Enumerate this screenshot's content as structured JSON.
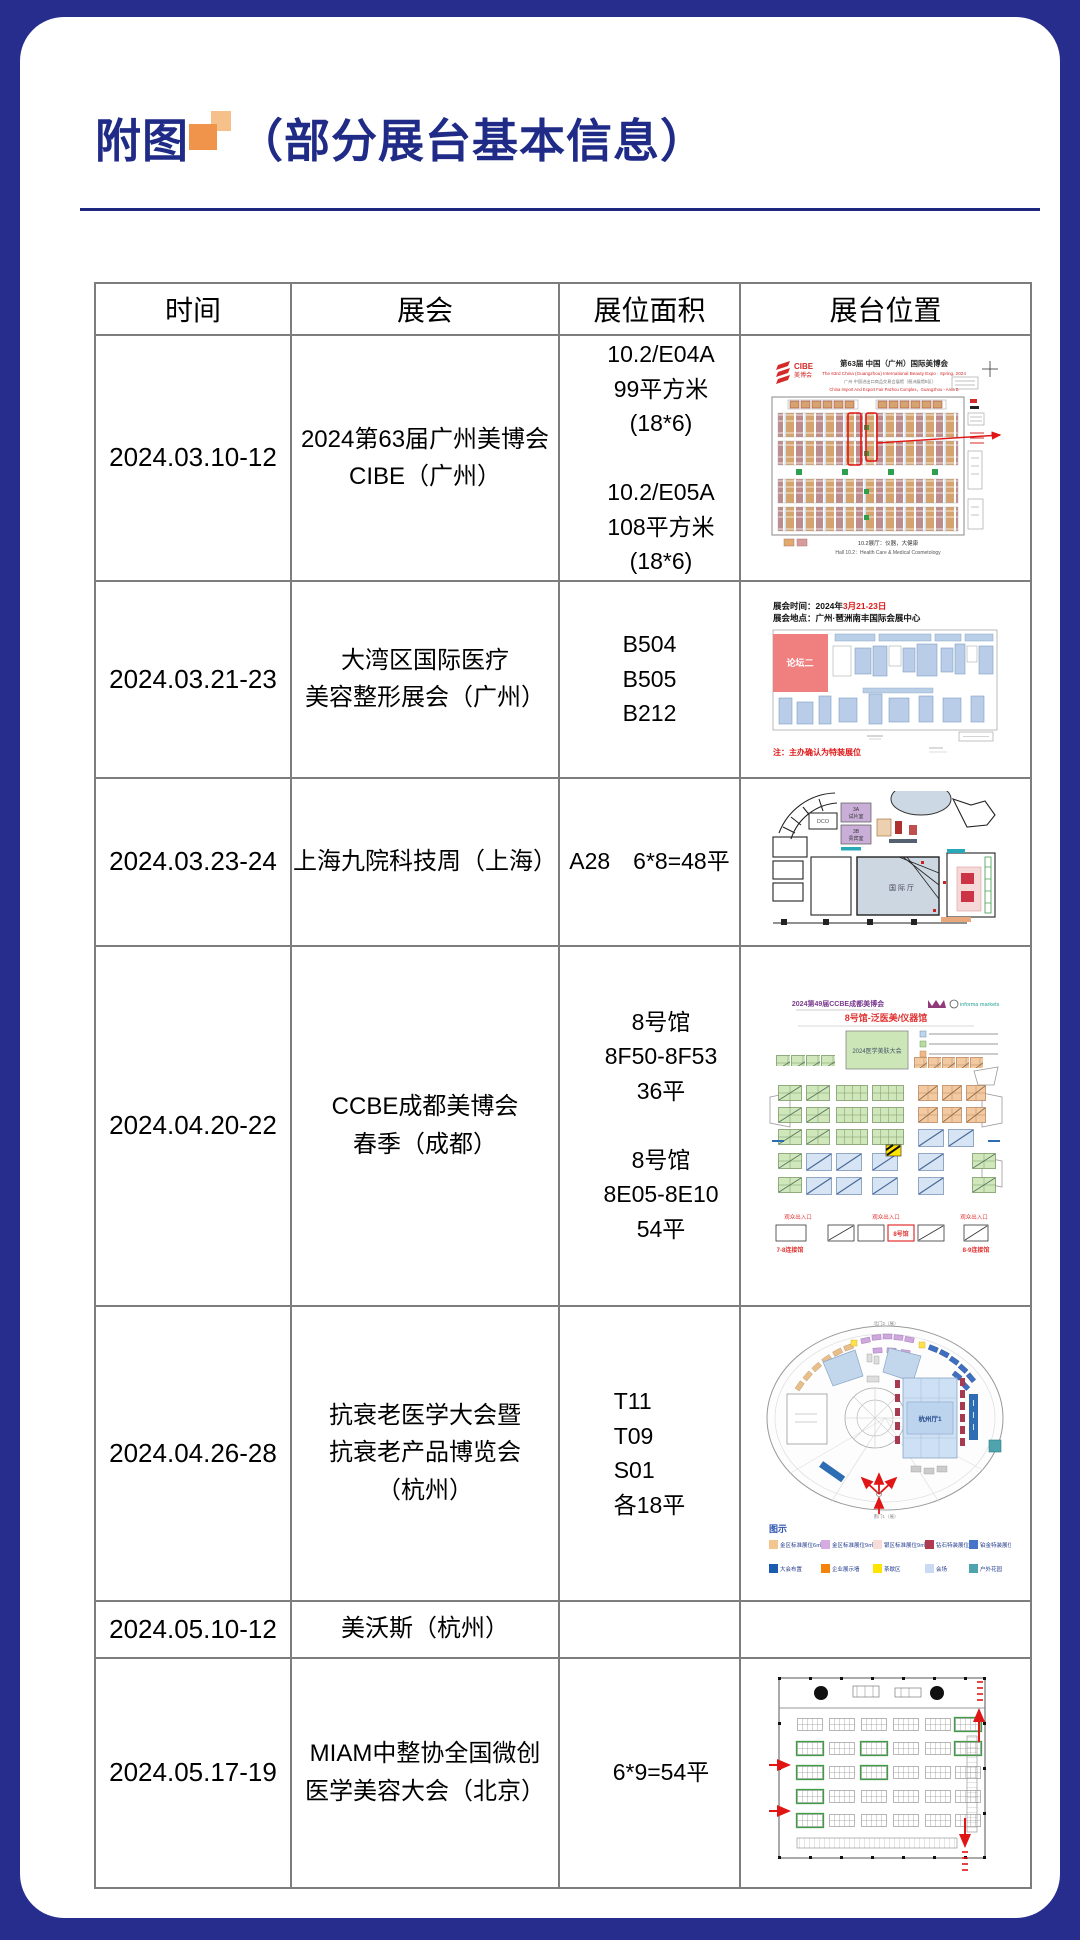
{
  "header": {
    "title_prefix": "附图",
    "title_suffix": "（部分展台基本信息）"
  },
  "colors": {
    "frame_navy": "#272d8c",
    "title_navy": "#1f2b87",
    "accent_orange_light": "#f6c08a",
    "accent_orange_dark": "#ef944a",
    "table_border_gray": "#7d7d7d"
  },
  "table": {
    "headers": [
      "时间",
      "展会",
      "展位面积",
      "展台位置"
    ],
    "rows": [
      {
        "date": "2024.03.10-12",
        "event": "2024第63届广州美博会\nCIBE（广州）",
        "area": "10.2/E04A\n99平方米(18*6)\n\n10.2/E05A\n108平方米(18*6)"
      },
      {
        "date": "2024.03.21-23",
        "event": "大湾区国际医疗\n美容整形展会（广州）",
        "area": "B504\nB505\nB212"
      },
      {
        "date": "2024.03.23-24",
        "event": "上海九院科技周（上海）",
        "area": "A28　6*8=48平"
      },
      {
        "date": "2024.04.20-22",
        "event": "CCBE成都美博会\n春季（成都）",
        "area": "8号馆\n8F50-8F53　36平\n\n8号馆\n8E05-8E10　 54平"
      },
      {
        "date": "2024.04.26-28",
        "event": "抗衰老医学大会暨\n抗衰老产品博览会\n（杭州）",
        "area": "T11\nT09\nS01\n各18平"
      },
      {
        "date": "2024.05.10-12",
        "event": "美沃斯（杭州）",
        "area": ""
      },
      {
        "date": "2024.05.17-19",
        "event": "MIAM中整协全国微创\n医学美容大会（北京）",
        "area": "6*9=54平"
      }
    ]
  },
  "plans": {
    "cibe": {
      "logo": "CIBE",
      "logo_sub": "美博会",
      "title": "第63届 中国（广州）国际美博会",
      "subtitle_en": "The 63rd China (Guangzhou) International Beauty Expo · Spring, 2024",
      "venue_cn": "广州·中国进出口商品交易会展馆（琶洲展馆B区）",
      "venue_en": "China Import And Export Fair Pazhou Complex，Guangzhou - Area B",
      "legend_cn": "10.2展厅：仪器，大健康",
      "legend_en": "Hall 10.2：Health Care & Medical Cosmetology"
    },
    "bay": {
      "time": "展会时间：2024年",
      "time_red": "3月21-23日",
      "place": "展会地点：广州·琶洲南丰国际会展中心",
      "forum": "论坛二",
      "note": "注：主办确认为特装展位"
    },
    "ninth": {
      "room_a": "3A",
      "room_a2": "试片室",
      "room_b": "3B",
      "room_b2": "贵宾室",
      "dco": "DCO",
      "hall": "国际厅"
    },
    "ccbe": {
      "title": "2024第49届CCBE成都美博会",
      "informa": "informa markets",
      "hall_line": "8号馆-泛医美/仪器馆",
      "room": "2024医学美肤大会",
      "gate": "观众出入口",
      "hall_box": "8号馆",
      "link_left": "7-8连接馆",
      "link_right": "8-9连接馆"
    },
    "anti": {
      "north": "北门2（展）",
      "hall": "杭州厅1",
      "legend_title": "图示",
      "l1": [
        {
          "c": "#f2c68e",
          "t": "金区标准展位6㎡"
        },
        {
          "c": "#d6aae2",
          "t": "金区标准展位9㎡"
        },
        {
          "c": "#f8dcd8",
          "t": "银区标准展位9㎡"
        },
        {
          "c": "#b23a50",
          "t": "钻石特装展位"
        },
        {
          "c": "#4774c8",
          "t": "铂金特装展位"
        }
      ],
      "l2": [
        {
          "c": "#1c5cb0",
          "t": "大会布置"
        },
        {
          "c": "#f5820a",
          "t": "企业展示墙"
        },
        {
          "c": "#ffe400",
          "t": "茶歇区"
        },
        {
          "c": "#c9daf2",
          "t": "会场"
        },
        {
          "c": "#4fa3ad",
          "t": "户外花园"
        }
      ]
    }
  }
}
